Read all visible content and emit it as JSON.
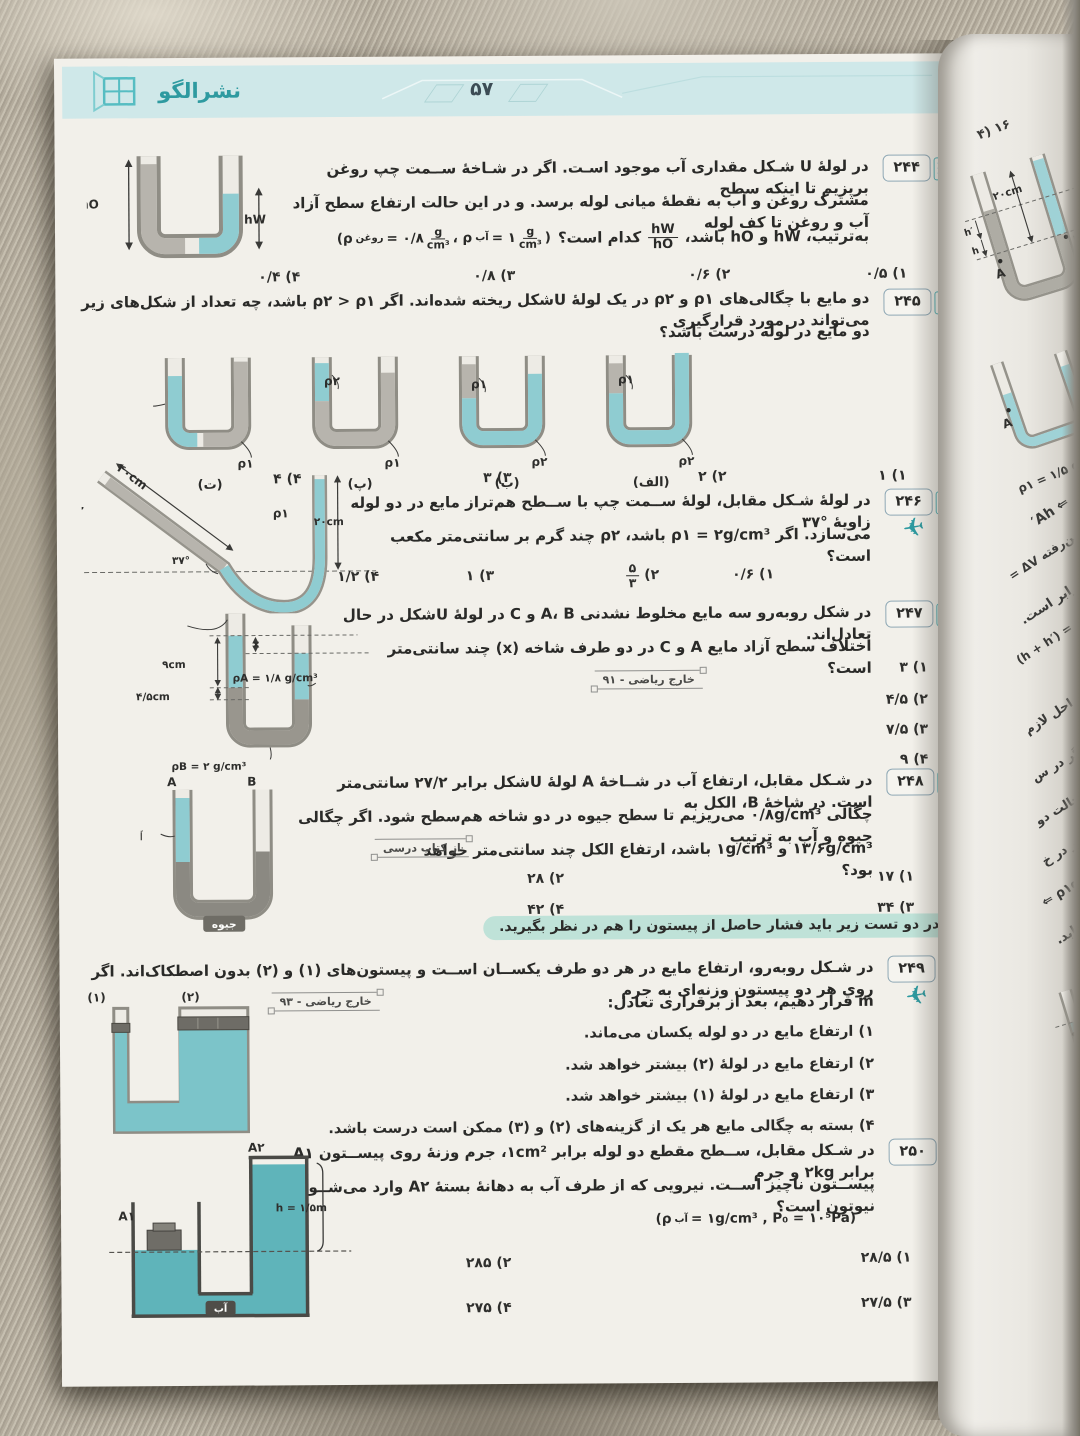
{
  "icons": {
    "plane": "✈"
  },
  "header": {
    "brand": "نشرالگو",
    "page_number": "۵۷"
  },
  "note": "در دو تست زیر باید فشار حاصل از پیستون را هم در نظر بگیرید.",
  "p244": {
    "number": "۲۴۴",
    "l1": "در لولهٔ U شـکل مقداری آب موجود اسـت. اگر در شـاخهٔ ســمت چپ روغن بریزیم تا اینکه سطح",
    "l2": "مشترک روغن و آب به نقطهٔ میانی لوله برسد. و در این حالت ارتفاع سطح آزاد آب و روغن تا کف لوله",
    "l3a": "به‌ترتیب، ‎hW‎ و ‎hO‎ باشد،",
    "frac": {
      "num": "hW",
      "den": "hO"
    },
    "l3b": "کدام است؟",
    "formula": {
      "pre": "(ρ",
      "sub1": "روغن",
      "eq1": " = ۰/۸ ",
      "mid": "، ρ",
      "sub2": "آب",
      "eq2": " = ۱ ",
      "unit_num": "g",
      "unit_den": "cm³",
      "close": ")"
    },
    "fig": {
      "left": "hO",
      "right": "hW"
    },
    "options": [
      "۱) ۰/۵",
      "۲) ۰/۶",
      "۳) ۰/۸",
      "۴) ۰/۴"
    ]
  },
  "p245": {
    "number": "۲۴۵",
    "l1": "دو مایع با چگالی‌های ‎ρ۱‎ و ‎ρ۲‎ در یک لولهٔ ‎U‎شکل ریخته شده‌اند. اگر ‎ρ۲ > ρ۱‎ باشد، چه تعداد از شکل‌های زیر می‌تواند در مورد قرارگیری",
    "l2": "دو مایع در لوله درست باشد؟",
    "figs": [
      {
        "caption": "(الف)",
        "top": "ρ۱",
        "bottom": "ρ۲"
      },
      {
        "caption": "(ب)",
        "top": "ρ۱",
        "bottom": "ρ۲"
      },
      {
        "caption": "(پ)",
        "top": "ρ۲",
        "bottom": "ρ۱"
      },
      {
        "caption": "(ت)",
        "top": "ρ۲",
        "bottom": "ρ۱"
      }
    ],
    "options": [
      "۱) ۱",
      "۲) ۲",
      "۳) ۳",
      "۴) ۴"
    ]
  },
  "p246": {
    "number": "۲۴۶",
    "l1": "در لولهٔ شـکل مقابل، لولهٔ ســمت چپ با ســطح هم‌تراز مایع در دو لوله زاویهٔ ‎۳۷°‎",
    "l2": "می‌سازد. اگر ‎ρ۱ = ۲g/cm³‎ باشد، ‎ρ۲‎ چند گرم بر سانتی‌متر مکعب است؟",
    "fig": {
      "rho2": "ρ۲",
      "len40": "۴۰cm",
      "angle": "۳۷°",
      "rho1": "ρ۱",
      "len20": "۲۰cm"
    },
    "opt1": "۱) ۰/۶",
    "opt2_label": "۲)",
    "frac": {
      "num": "۵",
      "den": "۳"
    },
    "opt3": "۳) ۱",
    "opt4": "۴) ۱/۲"
  },
  "p247": {
    "number": "۲۴۷",
    "l1": "در شکل روبه‌رو سه مایع مخلوط نشدنی ‎A‎، ‎B‎ و ‎C‎ در لولهٔ ‎U‎شکل در حال تعادل‌اند.",
    "l2": "اختلاف سطح آزاد مایع ‎A‎ و ‎C‎ در دو طرف شاخه (‎x‎) چند سانتی‌متر است؟",
    "src": "خارج ریاضی - ۹۱",
    "fig": {
      "rhoC": "ρC = ۰/۸ g/cm³",
      "x": "x",
      "d9": "۹cm",
      "d45": "۴/۵cm",
      "rhoA": "ρA = ۱/۸ g/cm³",
      "rhoB": "ρB = ۲ g/cm³"
    },
    "options": [
      "۱) ۳",
      "۲) ۴/۵",
      "۳) ۷/۵",
      "۴) ۹"
    ]
  },
  "p248": {
    "number": "۲۴۸",
    "l1": "در شـکل مقابل، ارتفاع آب در شــاخهٔ ‎A‎ لولهٔ ‎U‎شکل برابر ۲۷/۲ سانتی‌متر است. در شاخهٔ ‎B‎، الکل به",
    "l2": "چگالی ‎۰/۸g/cm³‎ می‌ریزیم تا سطح جیوه در دو شاخه هم‌سطح شود. اگر چگالی جیوه و آب به ترتیب",
    "l3": "‎۱۳/۶g/cm³‎ و ‎۱g/cm³‎ باشد، ارتفاع الکل چند سانتی‌متر خواهد بود؟",
    "src": "از کتاب درسی",
    "fig": {
      "a": "A",
      "b": "B",
      "water": "آب",
      "mercury": "جیوه"
    },
    "options": [
      "۱) ۱۷",
      "۲) ۲۸",
      "۳) ۳۴",
      "۴) ۴۲"
    ]
  },
  "p249": {
    "number": "۲۴۹",
    "l1": "در شـکل روبه‌رو، ارتفاع مایع در هر دو طرف یکســان اســت و پیستون‌های (۱) و (۲) بدون اصطکاک‌اند. اگر روی هر دو پیستون وزنه‌ای به جرم",
    "l2": "‎m‎ قرار دهیم، بعد از برقراری تعادل:",
    "src": "خارج ریاضی - ۹۳",
    "fig": {
      "p1": "(۱)",
      "p2": "(۲)"
    },
    "options": [
      "۱) ارتفاع مایع در دو لوله یکسان می‌ماند.",
      "۲) ارتفاع مایع در لولهٔ (۲) بیشتر خواهد شد.",
      "۳) ارتفاع مایع در لولهٔ (۱) بیشتر خواهد شد.",
      "۴) بسته به چگالی مایع هر یک از گزینه‌های (۲) و (۳) ممکن است درست باشد."
    ]
  },
  "p250": {
    "number": "۲۵۰",
    "l1": "در شـکل مقابل، ســطح مقطع دو لوله برابر ‎۱cm²‎، جرم وزنهٔ روی پیســتون ‎A۱‎ برابر ‎۲kg‎ و جرم",
    "l2": "پیســتون ناچیز اســت. نیرویی که از طرف آب به دهانهٔ بستهٔ ‎A۲‎ وارد می‌شــود، چند نیوتون است؟",
    "formula": {
      "pre": "(ρ",
      "sub": "آب",
      "rest": " = ۱g/cm³ , P₀ = ۱۰⁵Pa)"
    },
    "fig": {
      "a1": "A۱",
      "a2": "A۲",
      "h": "h = ۱/۵m",
      "water": "آب"
    },
    "options": [
      "۱) ۲۸/۵",
      "۲) ۲۸۵",
      "۳) ۲۷/۵",
      "۴) ۲۷۵"
    ]
  },
  "right_page": {
    "frag_opt": "۱۶ (۴",
    "fig1": {
      "len": "۲۰cm",
      "hp": "h′",
      "h": "h",
      "a": "A",
      "b": "B"
    },
    "frags": [
      "⇐ Ah′",
      "پایین‌رفته ΔV =",
      "چپ برابر است.",
      "(h + h′) = ρ",
      "ثل، طی کردن این مراحل لازم",
      "نیز بالا می‌آید. اگر در س",
      "خط هم‌تراز را در حالت دو",
      "ρ۱ قرار دارد. فشار در خ",
      "⇐ ρ۱gh۱ = ρ۲gh۲ =",
      "ر افزایش می‌یابد."
    ],
    "fig2": {
      "rho": "ρ۱ = ۱/۵ g/cm",
      "a": "A"
    },
    "state": "حالت اول",
    "frag_q": "مایع A است؟",
    "fig3": {
      "len": "۲۰cm",
      "a": "A"
    },
    "fig4": {
      "oil": "روغن"
    }
  }
}
